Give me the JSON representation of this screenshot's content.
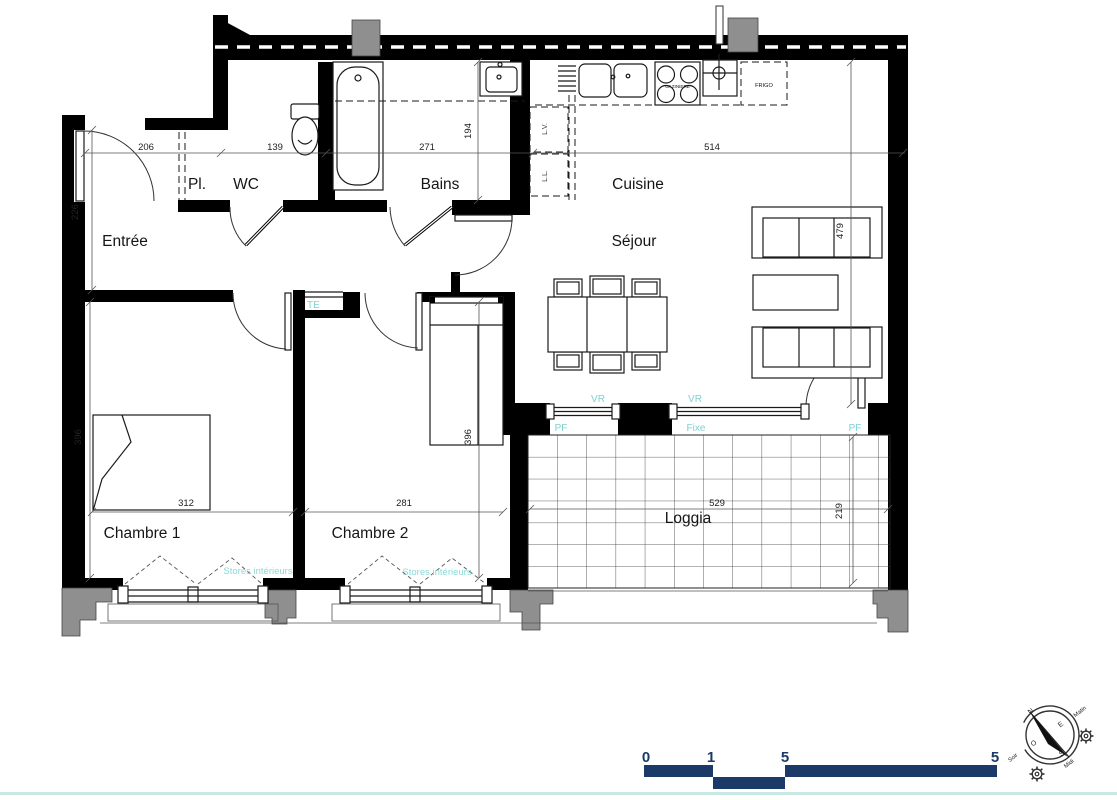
{
  "rooms": {
    "entree": "Entrée",
    "placard": "Pl.",
    "wc": "WC",
    "bains": "Bains",
    "cuisine": "Cuisine",
    "sejour": "Séjour",
    "chambre1": "Chambre 1",
    "chambre2": "Chambre 2",
    "loggia": "Loggia"
  },
  "dims": {
    "d206": "206",
    "d139": "139",
    "d271": "271",
    "d514": "514",
    "d194": "194",
    "d226": "226",
    "d479": "479",
    "d396a": "396",
    "d396b": "396",
    "d312": "312",
    "d281": "281",
    "d529": "529",
    "d219": "219"
  },
  "fixtures": {
    "gaziniere": "GAZINIERE",
    "frigo": "FRIGO",
    "lv": "L.V.",
    "ll": "L.L."
  },
  "openings": {
    "te": "TE",
    "vr1": "VR",
    "vr2": "VR",
    "pf1": "PF",
    "fixe": "Fixe",
    "pf2": "PF",
    "stores1": "Stores intérieurs",
    "stores2": "Stores intérieurs"
  },
  "scalebar": {
    "t0": "0",
    "t1": "1",
    "t2": "2",
    "t5": "5"
  },
  "compass": {
    "n": "N",
    "e": "E",
    "s": "S",
    "o": "O",
    "matin": "Matin",
    "midi": "Midi",
    "soir": "Soir"
  },
  "colors": {
    "wall": "#000000",
    "teal_labels": "#7fd1d1",
    "scalebar_navy": "#1b3a68",
    "duct_gray": "#8f8f8f",
    "footer_line": "#c9e7e3"
  }
}
